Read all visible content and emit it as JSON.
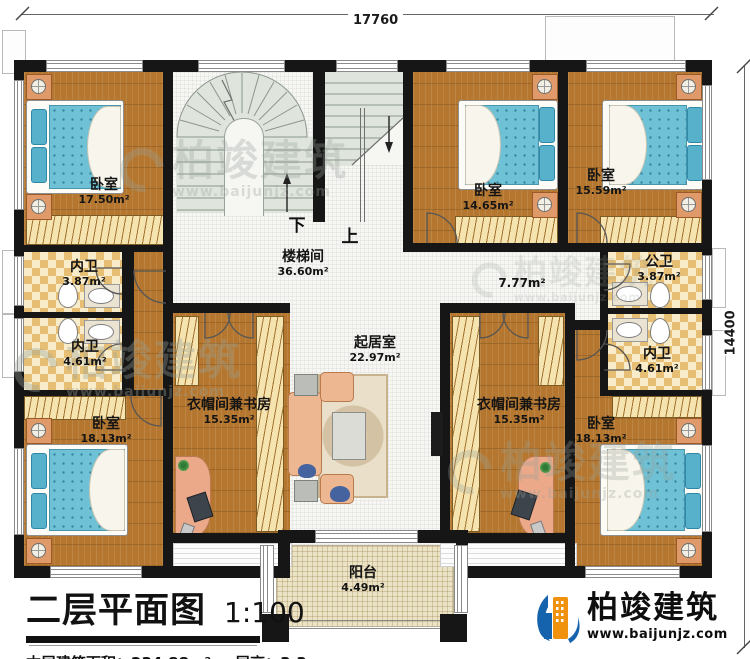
{
  "page": {
    "title": "二层平面图",
    "scale": "1:100",
    "stats": {
      "area_label": "本层建筑面积：",
      "area_value": "234.88m²",
      "height_label": "层高：",
      "height_value": "3.3m"
    }
  },
  "dimensions": {
    "width": "17760",
    "height": "14400"
  },
  "rooms": {
    "bedroom_tl": {
      "name": "卧室",
      "area": "17.50m²"
    },
    "bath_l1": {
      "name": "内卫",
      "area": "3.87m²"
    },
    "bath_l2": {
      "name": "内卫",
      "area": "4.61m²"
    },
    "bedroom_bl": {
      "name": "卧室",
      "area": "18.13m²"
    },
    "cloak_l": {
      "name": "衣帽间兼书房",
      "area": "15.35m²"
    },
    "stair_hall": {
      "name": "楼梯间",
      "area": "36.60m²"
    },
    "living": {
      "name": "起居室",
      "area": "22.97m²"
    },
    "hallway": {
      "area": "7.77m²"
    },
    "bedroom_t1": {
      "name": "卧室",
      "area": "14.65m²"
    },
    "bedroom_t2": {
      "name": "卧室",
      "area": "15.59m²"
    },
    "bath_public": {
      "name": "公卫",
      "area": "3.87m²"
    },
    "bath_r": {
      "name": "内卫",
      "area": "4.61m²"
    },
    "cloak_r": {
      "name": "衣帽间兼书房",
      "area": "15.35m²"
    },
    "bedroom_br": {
      "name": "卧室",
      "area": "18.13m²"
    },
    "balcony": {
      "name": "阳台",
      "area": "4.49m²"
    }
  },
  "stairs": {
    "down": "下",
    "up": "上"
  },
  "brand": {
    "name": "柏竣建筑",
    "website": "www.baijunjz.com"
  },
  "watermark": {
    "name": "柏竣建筑",
    "website": "www.baijunjz.com"
  },
  "colors": {
    "wall": "#161616",
    "wood_floor": "#b5772f",
    "tile_floor": "#ecca86",
    "stair_floor": "#dfe5dd",
    "bed": "#6fc1d6",
    "sofa": "#edb792",
    "brand_blue": "#1663ad",
    "brand_orange": "#f0920e"
  }
}
